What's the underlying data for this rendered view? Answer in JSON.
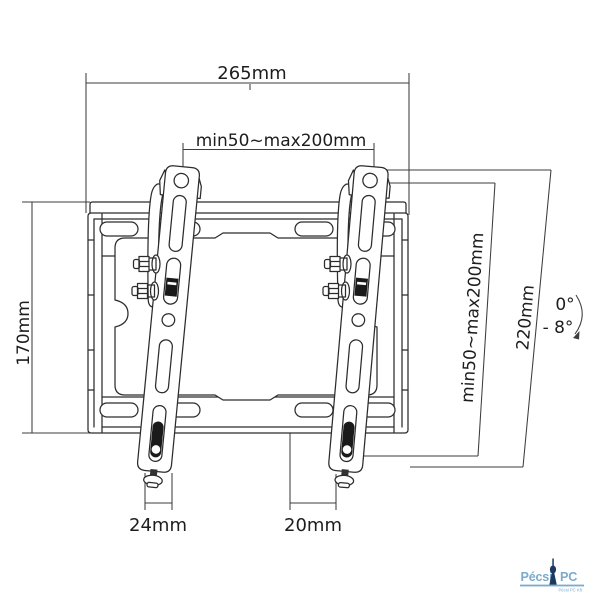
{
  "dimensions": {
    "top_width": "265mm",
    "vesa_width": "min50~max200mm",
    "plate_height": "170mm",
    "vesa_height": "min50~max200mm",
    "arm_height": "220mm",
    "tilt_min": "0°",
    "tilt_max": "- 8°",
    "left_bottom": "24mm",
    "right_bottom": "20mm"
  },
  "colors": {
    "background": "#ffffff",
    "drawing_line": "#2c2c2c",
    "dimension_line": "#3d3d3d",
    "text": "#1d1d1d",
    "logo_text": "#7babce",
    "logo_tower": "#1d3a5e"
  },
  "logo": {
    "primary": "Pécsi",
    "secondary": "PC",
    "tagline": "Pécsi PC Kft"
  }
}
